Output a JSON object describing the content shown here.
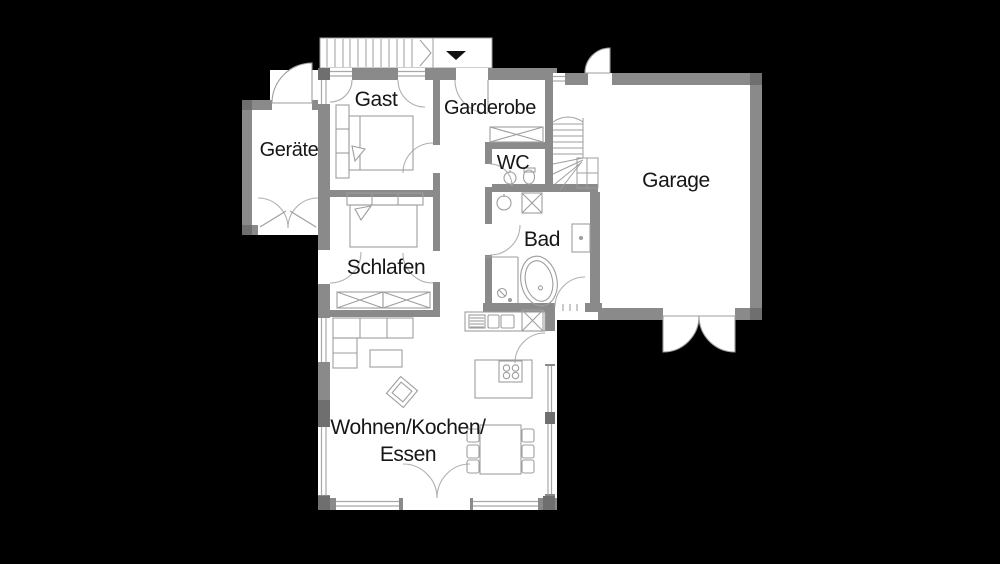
{
  "title": "Erdgeschoss Grundriss (floor plan)",
  "colors": {
    "background": "#000000",
    "floor": "#ffffff",
    "wall": "#8a8a8a",
    "wall_dark": "#6f6f6f",
    "line": "#9e9e9e",
    "window_line": "#a8a8a8",
    "door_arc": "#b0b0b0",
    "text": "#161616",
    "arrow": "#111111"
  },
  "rooms": {
    "gast": {
      "label": "Gast"
    },
    "garderobe": {
      "label": "Garderobe"
    },
    "geraete": {
      "label": "Geräte"
    },
    "wc": {
      "label": "WC"
    },
    "garage": {
      "label": "Garage"
    },
    "schlafen": {
      "label": "Schlafen"
    },
    "bad": {
      "label": "Bad"
    },
    "wohnen": {
      "line1": "Wohnen/Kochen/",
      "line2": "Essen"
    }
  },
  "entry": {
    "direction_arrow_icon": "triangle-down",
    "stairs_icon": "exterior-steps"
  }
}
